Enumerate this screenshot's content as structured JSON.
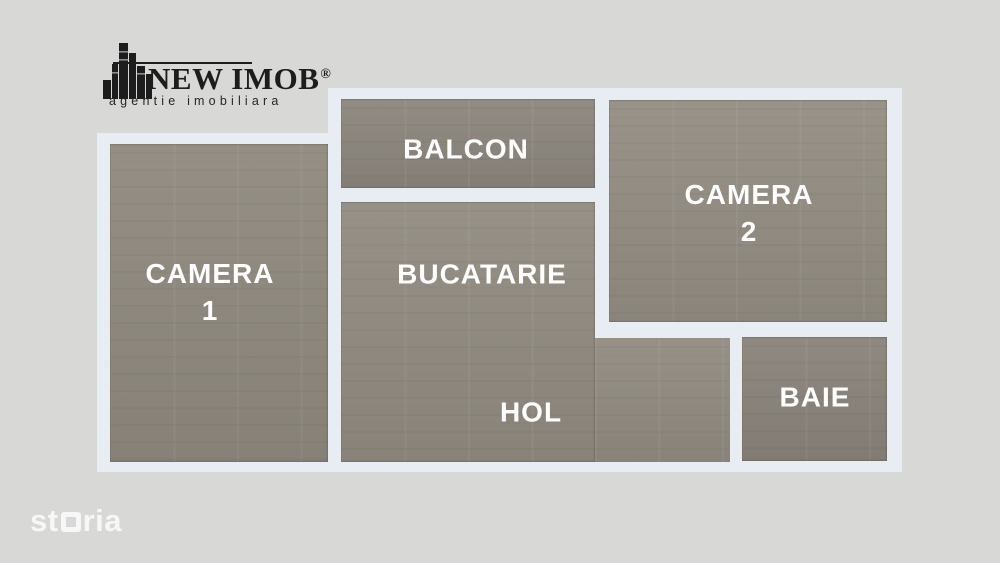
{
  "page": {
    "background_color": "#d8d8d6",
    "wall_color": "#e8edf4",
    "floor_color": "#8f897f",
    "label_color": "#ffffff"
  },
  "logo": {
    "brand": "NEW IMOB",
    "registered_mark": "®",
    "tagline": "agentie imobiliara",
    "icon": "buildings-skyline-icon",
    "text_color": "#1d1d1d"
  },
  "rooms": [
    {
      "id": "camera-1",
      "lines": [
        "CAMERA",
        "1"
      ]
    },
    {
      "id": "balcon",
      "lines": [
        "BALCON"
      ]
    },
    {
      "id": "bucatarie",
      "lines": [
        "BUCATARIE"
      ]
    },
    {
      "id": "hol",
      "lines": [
        "HOL"
      ]
    },
    {
      "id": "camera-2",
      "lines": [
        "CAMERA",
        "2"
      ]
    },
    {
      "id": "baie",
      "lines": [
        "BAIE"
      ]
    }
  ],
  "watermark": {
    "brand": "storia",
    "prefix": "st",
    "square_letter": "o",
    "suffix": "ria"
  }
}
